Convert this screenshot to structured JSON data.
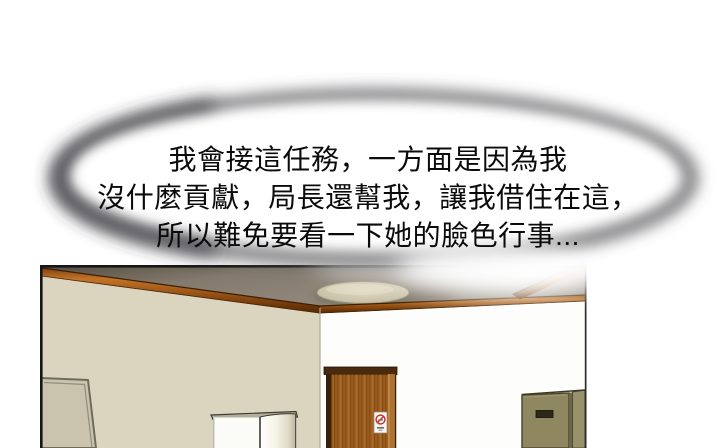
{
  "bubble": {
    "lines": [
      "我會接這任務，一方面是因為我",
      "沒什麼貢獻，局長還幫我，讓我借住在這，",
      "所以難免要看一下她的臉色行事..."
    ]
  },
  "panel": {
    "scene": "room-interior",
    "objects": [
      "ceiling-light",
      "wood-crown-molding",
      "leaning-board",
      "white-cabinet",
      "wooden-door",
      "no-smoking-sign",
      "locker-cabinet"
    ]
  },
  "colors": {
    "background": "#ffffff",
    "text": "#0b0b0b",
    "bubble_ring": "#57575a",
    "bubble_ring_dark": "#39393c",
    "wall_left": "#dbd5bf",
    "wall_right": "#fdfdfc",
    "ceiling_mid": "#8b8276",
    "ceiling_dark": "#5a5146",
    "wood_trim": "#b96a22",
    "door_slab": "#9a5c1e",
    "door_lintel": "#4a2a0e",
    "door_jamb_light": "#ad7130",
    "sign_red": "#c0392b",
    "light_fixture": "#cdc6ac",
    "board_fill": "#cac4ae",
    "cabinet_white": "#fbfbf8",
    "locker_face": "#8e8760",
    "panel_border": "#161616"
  }
}
